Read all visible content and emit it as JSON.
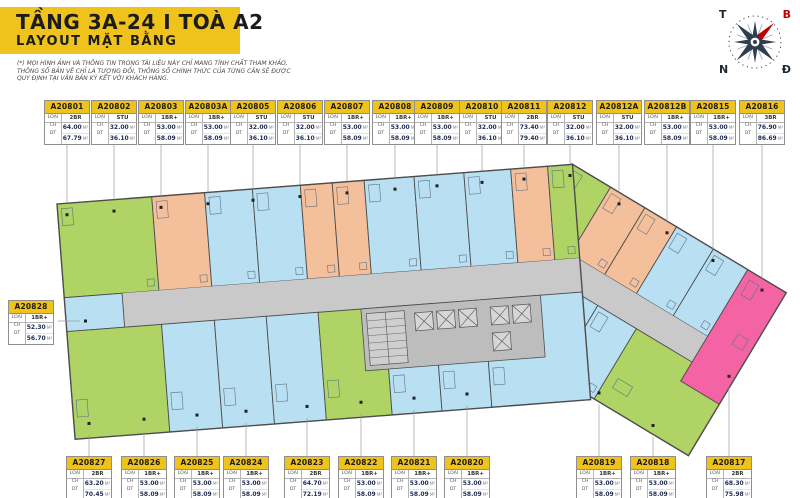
{
  "header": {
    "title": "TẦNG 3A-24 I TOÀ A2",
    "subtitle": "LAYOUT MẶT BẰNG"
  },
  "disclaimer": {
    "line1": "(*) MỌI HÌNH ẢNH VÀ THÔNG TIN TRONG TÀI LIỆU NÀY CHỈ MANG TÍNH CHẤT THAM KHẢO,",
    "line2": "THÔNG SỐ BẢN VẼ CHỈ LÀ TƯƠNG ĐỐI, THÔNG SỐ CHÍNH THỨC CỦA TỪNG CĂN SẼ ĐƯỢC",
    "line3": "QUY ĐỊNH TẠI VĂN BẢN KÝ KẾT VỚI KHÁCH HÀNG."
  },
  "compass": {
    "west": "T",
    "north": "B",
    "south": "N",
    "east": "Đ"
  },
  "card_labels": {
    "type": "LOẠI CH",
    "area": "DT",
    "unit_suffix": "M²"
  },
  "palette": {
    "yellow": "#EFC31C",
    "blue": "#B9E0F2",
    "green": "#AFD465",
    "orange": "#F4BF9B",
    "pink": "#F464A4",
    "corridor": "#C9C9C9",
    "core": "#BDBDBD",
    "outline": "#4D4D4D",
    "accent_red": "#C00000"
  },
  "type_colors": {
    "STU": "orange",
    "1BR+": "blue",
    "2BR": "green",
    "3BR": "pink"
  },
  "top_units": [
    {
      "id": "A20801",
      "type": "2BR",
      "area1": "64.00",
      "area2": "67.79"
    },
    {
      "id": "A20802",
      "type": "STU",
      "area1": "32.00",
      "area2": "36.10"
    },
    {
      "id": "A20803",
      "type": "1BR+",
      "area1": "53.00",
      "area2": "58.09"
    },
    {
      "id": "A20803A",
      "type": "1BR+",
      "area1": "53.00",
      "area2": "58.09"
    },
    {
      "id": "A20805",
      "type": "STU",
      "area1": "32.00",
      "area2": "36.10"
    },
    {
      "id": "A20806",
      "type": "STU",
      "area1": "32.00",
      "area2": "36.10"
    },
    {
      "id": "A20807",
      "type": "1BR+",
      "area1": "53.00",
      "area2": "58.09"
    },
    {
      "id": "A20808",
      "type": "1BR+",
      "area1": "53.00",
      "area2": "58.09"
    },
    {
      "id": "A20809",
      "type": "1BR+",
      "area1": "53.00",
      "area2": "58.09"
    },
    {
      "id": "A20810",
      "type": "STU",
      "area1": "32.00",
      "area2": "36.10"
    },
    {
      "id": "A20811",
      "type": "2BR",
      "area1": "73.40",
      "area2": "79.40"
    },
    {
      "id": "A20812",
      "type": "STU",
      "area1": "32.00",
      "area2": "36.10"
    },
    {
      "id": "A20812A",
      "type": "STU",
      "area1": "32.00",
      "area2": "36.10"
    },
    {
      "id": "A20812B",
      "type": "1BR+",
      "area1": "53.00",
      "area2": "58.09"
    },
    {
      "id": "A20815",
      "type": "1BR+",
      "area1": "53.00",
      "area2": "58.09"
    },
    {
      "id": "A20816",
      "type": "3BR",
      "area1": "76.90",
      "area2": "86.69"
    }
  ],
  "side_units": [
    {
      "id": "A20828",
      "type": "1BR+",
      "area1": "52.30",
      "area2": "56.70"
    }
  ],
  "bottom_units": [
    {
      "id": "A20827",
      "type": "2BR",
      "area1": "63.20",
      "area2": "70.45"
    },
    {
      "id": "A20826",
      "type": "1BR+",
      "area1": "53.00",
      "area2": "58.09"
    },
    {
      "id": "A20825",
      "type": "1BR+",
      "area1": "53.00",
      "area2": "58.09"
    },
    {
      "id": "A20824",
      "type": "1BR+",
      "area1": "53.00",
      "area2": "58.09"
    },
    {
      "id": "A20823",
      "type": "2BR",
      "area1": "64.70",
      "area2": "72.19"
    },
    {
      "id": "A20822",
      "type": "1BR+",
      "area1": "53.00",
      "area2": "58.09"
    },
    {
      "id": "A20821",
      "type": "1BR+",
      "area1": "53.00",
      "area2": "58.09"
    },
    {
      "id": "A20820",
      "type": "1BR+",
      "area1": "53.00",
      "area2": "58.09"
    },
    {
      "id": "A20819",
      "type": "1BR+",
      "area1": "53.00",
      "area2": "58.09"
    },
    {
      "id": "A20818",
      "type": "1BR+",
      "area1": "53.00",
      "area2": "58.09"
    },
    {
      "id": "A20817",
      "type": "2BR",
      "area1": "68.30",
      "area2": "75.98"
    }
  ]
}
